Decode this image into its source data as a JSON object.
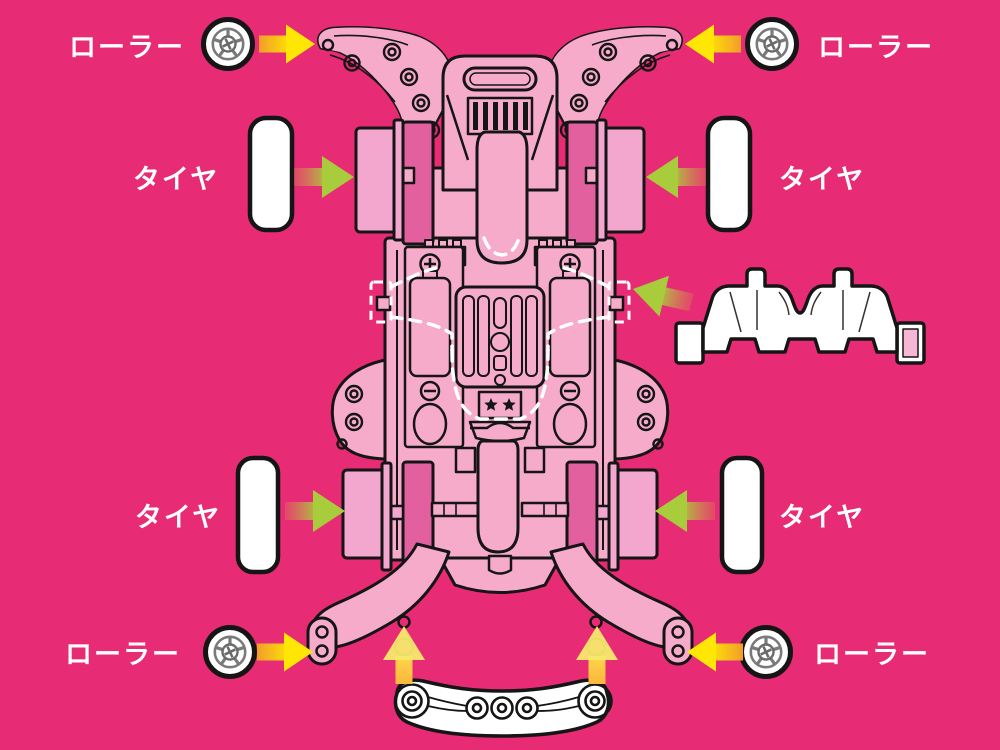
{
  "canvas": {
    "width": 1000,
    "height": 750,
    "background_color": "#E72B74"
  },
  "colors": {
    "background": "#E72B74",
    "chassis_pink": "#F6ABCB",
    "chassis_shadow_pink": "#E3609E",
    "wheel_pink": "#F3A6CE",
    "outline_black": "#151515",
    "part_white": "#FFFFFF",
    "arrow_yellow": "#FFE605",
    "arrow_orange_tail": "#F2992B",
    "arrow_green": "#A8CC3B",
    "label_text": "#FFFFFF"
  },
  "diagram": {
    "subject": "mini-4wd-chassis-exploded-parts-diagram",
    "center_part": "chassis",
    "parts": [
      {
        "id": "roller-top-left",
        "label": "ローラー",
        "icon": "roller-wheel-icon",
        "arrow_direction": "right",
        "arrow_color": "yellow"
      },
      {
        "id": "roller-top-right",
        "label": "ローラー",
        "icon": "roller-wheel-icon",
        "arrow_direction": "left",
        "arrow_color": "yellow"
      },
      {
        "id": "tire-upper-left",
        "label": "タイヤ",
        "icon": "tire-shape",
        "arrow_direction": "right",
        "arrow_color": "green"
      },
      {
        "id": "tire-upper-right",
        "label": "タイヤ",
        "icon": "tire-shape",
        "arrow_direction": "left",
        "arrow_color": "green"
      },
      {
        "id": "gear-cover-part",
        "label": "",
        "icon": "white-gear-cover",
        "arrow_direction": "down-left",
        "arrow_color": "green"
      },
      {
        "id": "tire-lower-left",
        "label": "タイヤ",
        "icon": "tire-shape",
        "arrow_direction": "right",
        "arrow_color": "green"
      },
      {
        "id": "tire-lower-right",
        "label": "タイヤ",
        "icon": "tire-shape",
        "arrow_direction": "left",
        "arrow_color": "green"
      },
      {
        "id": "roller-bottom-left",
        "label": "ローラー",
        "icon": "roller-wheel-icon",
        "arrow_direction": "right",
        "arrow_color": "yellow"
      },
      {
        "id": "roller-bottom-right",
        "label": "ローラー",
        "icon": "roller-wheel-icon",
        "arrow_direction": "left",
        "arrow_color": "yellow"
      },
      {
        "id": "rear-stay-part",
        "label": "",
        "icon": "white-rear-stay",
        "arrow_direction": "up",
        "arrow_color": "yellow",
        "arrow_count": 2
      }
    ]
  }
}
